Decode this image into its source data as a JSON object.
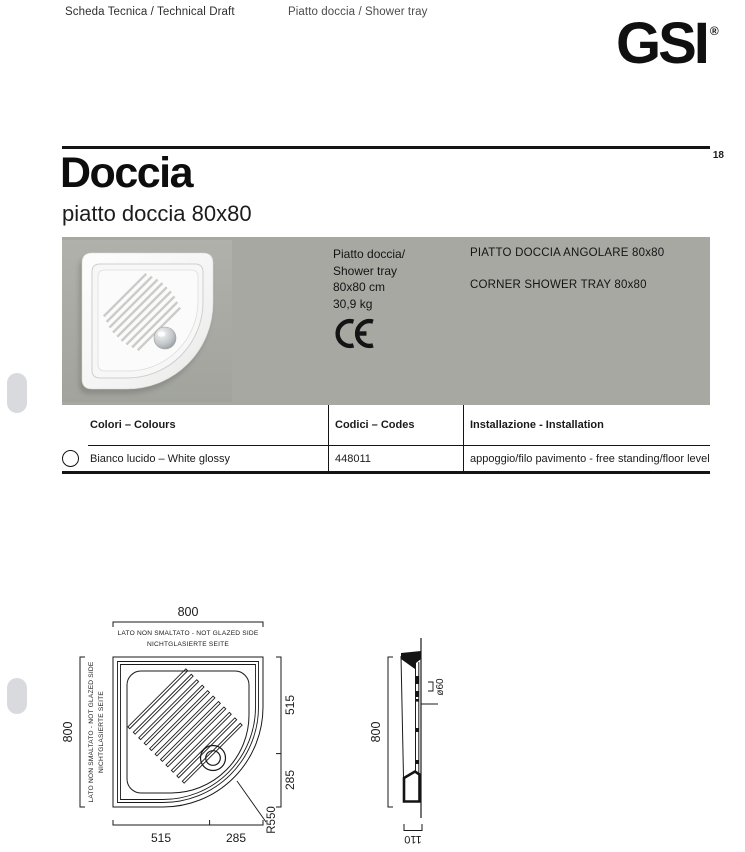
{
  "header": {
    "doc_type": "Scheda Tecnica / Technical Draft",
    "product_type": "Piatto doccia / Shower tray",
    "logo_text": "GSI",
    "logo_registered": "®",
    "page_number": "18"
  },
  "title": {
    "main": "Doccia",
    "subtitle": "piatto doccia 80x80"
  },
  "product_panel": {
    "band_color": "#a7a8a2",
    "spec_line1": "Piatto doccia/",
    "spec_line2": "Shower tray",
    "spec_line3": "80x80 cm",
    "spec_line4": "30,9 kg",
    "ce_mark": "CE",
    "name_it": "PIATTO DOCCIA ANGOLARE 80x80",
    "name_en": "CORNER SHOWER TRAY 80x80"
  },
  "table": {
    "header_colors": "Colori – Colours",
    "header_codes": "Codici – Codes",
    "header_installation": "Installazione - Installation",
    "row": {
      "color": "Bianco lucido – White glossy",
      "code": "448011",
      "installation": "appoggio/filo pavimento - free standing/floor level"
    }
  },
  "drawings": {
    "plan": {
      "top_dim": "800",
      "left_dim": "800",
      "right_dim_top": "515",
      "right_dim_bottom": "285",
      "bottom_dim_left": "515",
      "bottom_dim_right": "285",
      "radius_label": "R550",
      "note_line1": "LATO NON SMALTATO - NOT GLAZED SIDE",
      "note_line2": "NICHTGLASIERTE SEITE"
    },
    "section": {
      "length_dim": "800",
      "depth_dim": "110",
      "drain_dim": "ø60"
    }
  }
}
